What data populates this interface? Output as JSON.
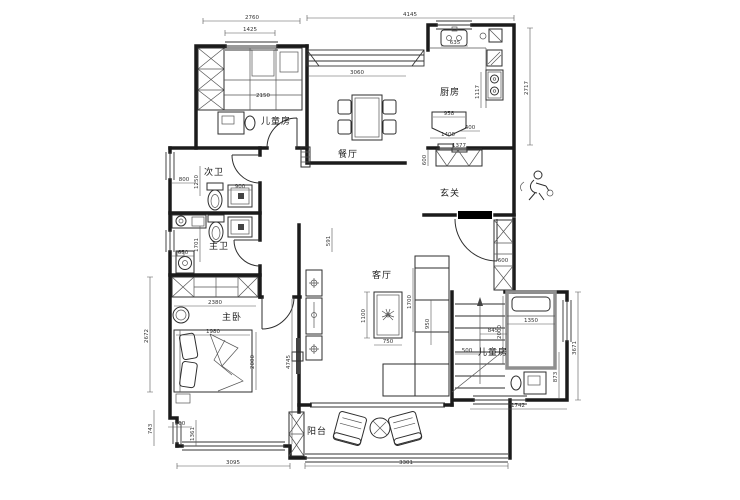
{
  "drawing": {
    "type": "residential-floor-plan",
    "colors": {
      "line": "#1b1b1b",
      "furniture": "#2e2e2e",
      "new_wall_gray": "#8f8f8f",
      "background": "#ffffff",
      "door_threshold": "#000000"
    }
  },
  "rooms": [
    {
      "id": "kids-room-top",
      "label": "儿童房"
    },
    {
      "id": "dining-room",
      "label": "餐厅"
    },
    {
      "id": "kitchen",
      "label": "厨房"
    },
    {
      "id": "bath-secondary",
      "label": "次卫"
    },
    {
      "id": "bath-master",
      "label": "主卫"
    },
    {
      "id": "foyer",
      "label": "玄关"
    },
    {
      "id": "living-room",
      "label": "客厅"
    },
    {
      "id": "master-bedroom",
      "label": "主卧"
    },
    {
      "id": "kids-room-bottom",
      "label": "儿童房"
    },
    {
      "id": "balcony",
      "label": "阳台"
    }
  ],
  "dims": [
    "2760",
    "1425",
    "4145",
    "3060",
    "2717",
    "635",
    "1117",
    "958",
    "400",
    "1400",
    "1377",
    "600",
    "800",
    "1250",
    "900",
    "1701",
    "650",
    "2380",
    "1980",
    "2000",
    "4745",
    "2672",
    "743",
    "560",
    "1361",
    "3095",
    "3301",
    "1100",
    "750",
    "1700",
    "950",
    "591",
    "500",
    "845",
    "1350",
    "2000",
    "873",
    "3671",
    "1742",
    "600",
    "2150"
  ]
}
